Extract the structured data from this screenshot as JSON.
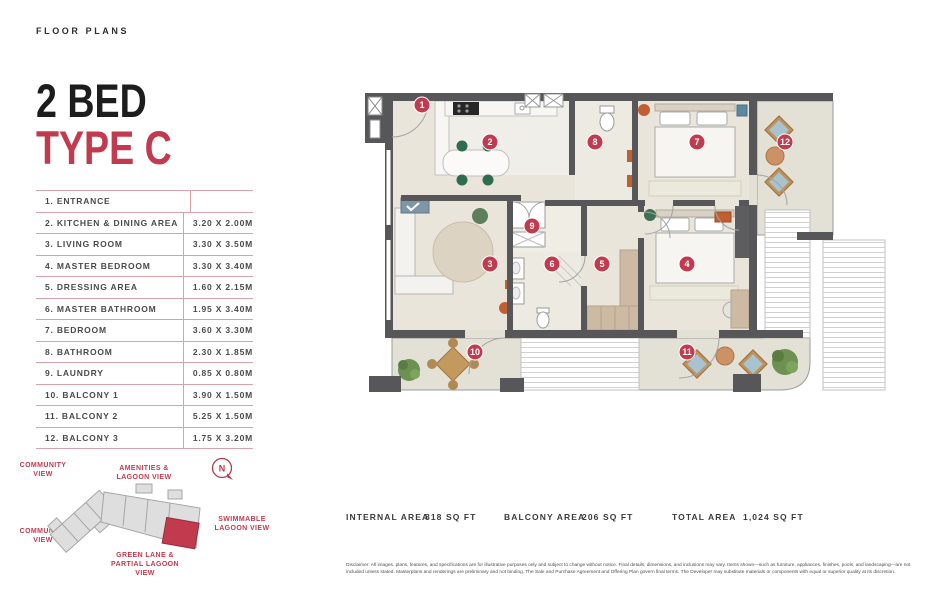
{
  "page": {
    "eyebrow": "FLOOR PLANS"
  },
  "title": {
    "line1": "2 BED",
    "line2": "TYPE C"
  },
  "colors": {
    "accent": "#c23a4e",
    "table_line": "#d9a2aa",
    "wall": "#57575a",
    "floor": "#eae5da",
    "balcony_floor": "#e3e0d6"
  },
  "rooms": [
    {
      "name": "1. ENTRANCE",
      "dim": ""
    },
    {
      "name": "2. KITCHEN & DINING AREA",
      "dim": "3.20 X 2.00M"
    },
    {
      "name": "3. LIVING ROOM",
      "dim": "3.30 X 3.50M"
    },
    {
      "name": "4. MASTER BEDROOM",
      "dim": "3.30 X 3.40M"
    },
    {
      "name": "5. DRESSING AREA",
      "dim": "1.60 X 2.15M"
    },
    {
      "name": "6. MASTER BATHROOM",
      "dim": "1.95 X 3.40M"
    },
    {
      "name": "7. BEDROOM",
      "dim": "3.60 X 3.30M"
    },
    {
      "name": "8. BATHROOM",
      "dim": "2.30 X 1.85M"
    },
    {
      "name": "9. LAUNDRY",
      "dim": "0.85 X 0.80M"
    },
    {
      "name": "10. BALCONY 1",
      "dim": "3.90 X 1.50M"
    },
    {
      "name": "11. BALCONY 2",
      "dim": "5.25 X 1.50M"
    },
    {
      "name": "12. BALCONY 3",
      "dim": "1.75 X 3.20M"
    }
  ],
  "key_plan": {
    "labels": {
      "community_top": "COMMUNITY\nVIEW",
      "amenities": "AMENITIES &\nLAGOON VIEW",
      "community_bottom": "COMMUNITY\nVIEW",
      "swimmable": "SWIMMABLE\nLAGOON VIEW",
      "green_lane": "GREEN LANE &\nPARTIAL LAGOON\nVIEW"
    },
    "compass": "N"
  },
  "floor_plan": {
    "markers": [
      "1",
      "2",
      "3",
      "4",
      "5",
      "6",
      "7",
      "8",
      "9",
      "10",
      "11",
      "12"
    ]
  },
  "areas": [
    {
      "label": "INTERNAL AREA",
      "value": "818 SQ FT"
    },
    {
      "label": "BALCONY AREA",
      "value": "206 SQ FT"
    },
    {
      "label": "TOTAL AREA",
      "value": "1,024 SQ FT"
    }
  ],
  "disclaimer": "Disclaimer: All images, plans, features, and specifications are for illustrative purposes only and subject to change without notice. Final details, dimensions, and inclusions may vary. Items shown—such as furniture, appliances, finishes, pools, and landscaping—are not included unless stated. Masterplans and renderings are preliminary and not binding. The Sale and Purchase Agreement and Offering Plan govern final terms. The Developer may substitute materials or components with equal or superior quality at its discretion."
}
